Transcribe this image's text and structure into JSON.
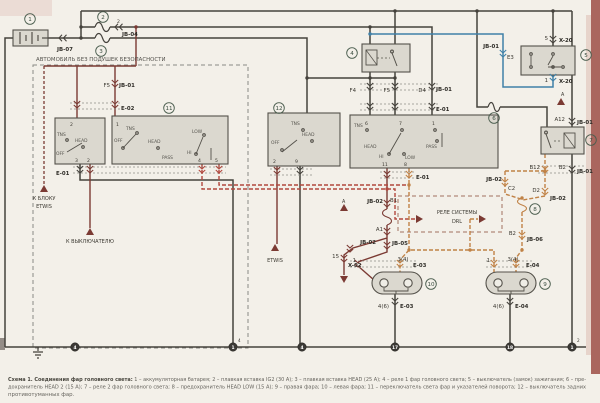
{
  "region_note": "АВТОМОБИЛЬ БЕЗ ПОДУШЕК БЕЗОПАСНОСТИ",
  "caption": {
    "bold": "Схема 1. Соединения фар головного света:",
    "line1": " 1 – аккумуляторная батарея; 2 – плавкая вставка IG2 (30 А); 3 – плавкая вставка HEAD (25 А); 4 – реле 1 фар головного света; 5 – выключатель (замок) зажигания; 6 – пре-",
    "line2": "дохранитель HEAD 2 (15 А); 7 – реле 2 фар головного света; 8 – предохранитель HEAD LOW (15 А); 9 – правая фара; 10 – левая фара; 11 – переключатель света фар и указателей поворота; 12 – выключатель задних",
    "line3": "противотуманных фар."
  },
  "labels": [
    {
      "t": "JB-07",
      "x": 57,
      "y": 51,
      "b": 1
    },
    {
      "t": "JB-04",
      "x": 122,
      "y": 36,
      "b": 1
    },
    {
      "t": "2",
      "x": 117,
      "y": 23,
      "s": 4.6
    },
    {
      "t": "АВТОМОБИЛЬ БЕЗ ПОДУШЕК БЕЗОПАСНОСТИ",
      "x": 36,
      "y": 61,
      "s": 5.4,
      "c": "#55534e"
    },
    {
      "t": "F5",
      "x": 110,
      "y": 87,
      "a": "e"
    },
    {
      "t": "JB-01",
      "x": 119,
      "y": 87,
      "b": 1
    },
    {
      "t": "E-02",
      "x": 121,
      "y": 110,
      "b": 1
    },
    {
      "t": "E-01",
      "x": 56,
      "y": 175,
      "b": 1
    },
    {
      "t": "К БЛОКУ",
      "x": 44,
      "y": 200,
      "a": "m",
      "s": 5
    },
    {
      "t": "ETWIS",
      "x": 44,
      "y": 208,
      "a": "m",
      "s": 5
    },
    {
      "t": "К ВЫКЛЮЧАТЕЛЮ",
      "x": 90,
      "y": 243,
      "a": "m",
      "s": 5
    },
    {
      "t": "ETWIS",
      "x": 275,
      "y": 262,
      "a": "m",
      "s": 5
    },
    {
      "t": "2",
      "x": 70,
      "y": 126,
      "s": 4.6
    },
    {
      "t": "TNS",
      "x": 57,
      "y": 136,
      "s": 4.4,
      "c": "#55534d"
    },
    {
      "t": "HEAD",
      "x": 75,
      "y": 142,
      "s": 4.4,
      "c": "#55534d"
    },
    {
      "t": "OFF",
      "x": 56,
      "y": 155,
      "s": 4.4,
      "c": "#55534d"
    },
    {
      "t": "3",
      "x": 75,
      "y": 162,
      "s": 4.6
    },
    {
      "t": "2",
      "x": 87,
      "y": 162,
      "s": 4.6
    },
    {
      "t": "1",
      "x": 116,
      "y": 126,
      "s": 4.6
    },
    {
      "t": "TNS",
      "x": 126,
      "y": 130,
      "s": 4.4,
      "c": "#55534d"
    },
    {
      "t": "OFF",
      "x": 114,
      "y": 142,
      "s": 4.4,
      "c": "#55534d"
    },
    {
      "t": "HEAD",
      "x": 148,
      "y": 143,
      "s": 4.4,
      "c": "#55534d"
    },
    {
      "t": "LOW",
      "x": 192,
      "y": 133,
      "s": 4.4,
      "c": "#55534d"
    },
    {
      "t": "HI",
      "x": 187,
      "y": 154,
      "s": 4.4,
      "c": "#55534d"
    },
    {
      "t": "PASS",
      "x": 162,
      "y": 159,
      "s": 4.4,
      "c": "#55534d"
    },
    {
      "t": "4",
      "x": 198,
      "y": 162,
      "s": 4.6
    },
    {
      "t": "5",
      "x": 215,
      "y": 162,
      "s": 4.6
    },
    {
      "t": "F4",
      "x": 356,
      "y": 92,
      "a": "e"
    },
    {
      "t": "F5",
      "x": 390,
      "y": 92,
      "a": "e"
    },
    {
      "t": "D4",
      "x": 426,
      "y": 92,
      "a": "e"
    },
    {
      "t": "JB-01",
      "x": 436,
      "y": 91,
      "b": 1
    },
    {
      "t": "E-01",
      "x": 436,
      "y": 111,
      "b": 1
    },
    {
      "t": "6",
      "x": 365,
      "y": 125,
      "s": 4.6
    },
    {
      "t": "7",
      "x": 399,
      "y": 125,
      "s": 4.6
    },
    {
      "t": "1",
      "x": 432,
      "y": 125,
      "s": 4.6
    },
    {
      "t": "TNS",
      "x": 354,
      "y": 127,
      "s": 4.4,
      "c": "#55534d"
    },
    {
      "t": "HEAD",
      "x": 364,
      "y": 148,
      "s": 4.4,
      "c": "#55534d"
    },
    {
      "t": "HI",
      "x": 379,
      "y": 158,
      "s": 4.4,
      "c": "#55534d"
    },
    {
      "t": "LOW",
      "x": 405,
      "y": 159,
      "s": 4.4,
      "c": "#55534d"
    },
    {
      "t": "PASS",
      "x": 426,
      "y": 148,
      "s": 4.4,
      "c": "#55534d"
    },
    {
      "t": "11",
      "x": 382,
      "y": 166,
      "s": 4.6
    },
    {
      "t": "8",
      "x": 404,
      "y": 166,
      "s": 4.6
    },
    {
      "t": "E-01",
      "x": 416,
      "y": 179,
      "b": 1
    },
    {
      "t": "TNS",
      "x": 291,
      "y": 125,
      "s": 4.4,
      "c": "#55534d"
    },
    {
      "t": "HEAD",
      "x": 302,
      "y": 136,
      "s": 4.4,
      "c": "#55534d"
    },
    {
      "t": "OFF",
      "x": 271,
      "y": 144,
      "s": 4.4,
      "c": "#55534d"
    },
    {
      "t": "2",
      "x": 273,
      "y": 163,
      "s": 4.6
    },
    {
      "t": "9",
      "x": 295,
      "y": 163,
      "s": 4.6
    },
    {
      "t": "JB-02",
      "x": 383,
      "y": 203,
      "a": "e",
      "b": 1
    },
    {
      "t": "B1",
      "x": 390,
      "y": 202
    },
    {
      "t": "A1",
      "x": 383,
      "y": 231,
      "a": "e"
    },
    {
      "t": "JB-02",
      "x": 376,
      "y": 244,
      "a": "e",
      "b": 1
    },
    {
      "t": "JB-05",
      "x": 392,
      "y": 245,
      "b": 1
    },
    {
      "t": "15",
      "x": 339,
      "y": 258,
      "a": "e"
    },
    {
      "t": "X-02",
      "x": 348,
      "y": 267,
      "b": 1
    },
    {
      "t": "РЕЛЕ СИСТЕМЫ",
      "x": 457,
      "y": 214,
      "a": "m",
      "s": 5
    },
    {
      "t": "DRL",
      "x": 457,
      "y": 223,
      "a": "m",
      "s": 5
    },
    {
      "t": "JB-02",
      "x": 502,
      "y": 181,
      "a": "e",
      "b": 1
    },
    {
      "t": "C2",
      "x": 508,
      "y": 190
    },
    {
      "t": "B12",
      "x": 540,
      "y": 169,
      "a": "e"
    },
    {
      "t": "D2",
      "x": 540,
      "y": 192,
      "a": "e"
    },
    {
      "t": "JB-02",
      "x": 550,
      "y": 200,
      "b": 1
    },
    {
      "t": "B2",
      "x": 516,
      "y": 235,
      "a": "e"
    },
    {
      "t": "JB-06",
      "x": 527,
      "y": 241,
      "b": 1
    },
    {
      "t": "A12",
      "x": 565,
      "y": 121,
      "a": "e"
    },
    {
      "t": "JB-01",
      "x": 577,
      "y": 124,
      "b": 1
    },
    {
      "t": "B2",
      "x": 566,
      "y": 169,
      "a": "e"
    },
    {
      "t": "JB-01",
      "x": 577,
      "y": 173,
      "b": 1
    },
    {
      "t": "5",
      "x": 548,
      "y": 40,
      "a": "e"
    },
    {
      "t": "X-20",
      "x": 559,
      "y": 42,
      "b": 1
    },
    {
      "t": "1",
      "x": 548,
      "y": 82,
      "a": "e"
    },
    {
      "t": "X-20",
      "x": 559,
      "y": 83,
      "b": 1
    },
    {
      "t": "JB-01",
      "x": 499,
      "y": 48,
      "a": "e",
      "b": 1
    },
    {
      "t": "E3",
      "x": 507,
      "y": 59
    },
    {
      "t": "1",
      "x": 356,
      "y": 262,
      "a": "e"
    },
    {
      "t": "3(4)",
      "x": 403,
      "y": 261,
      "a": "m"
    },
    {
      "t": "E-03",
      "x": 413,
      "y": 267,
      "b": 1
    },
    {
      "t": "4(6)",
      "x": 389,
      "y": 308,
      "a": "e"
    },
    {
      "t": "E-03",
      "x": 400,
      "y": 308,
      "b": 1
    },
    {
      "t": "1",
      "x": 490,
      "y": 262,
      "a": "e"
    },
    {
      "t": "3(4)",
      "x": 513,
      "y": 261,
      "a": "m"
    },
    {
      "t": "E-04",
      "x": 526,
      "y": 267,
      "b": 1
    },
    {
      "t": "4(6)",
      "x": 504,
      "y": 308,
      "a": "e"
    },
    {
      "t": "E-04",
      "x": 515,
      "y": 308,
      "b": 1
    },
    {
      "t": "A",
      "x": 342,
      "y": 203,
      "s": 4.8
    },
    {
      "t": "A",
      "x": 561,
      "y": 96,
      "s": 4.8
    },
    {
      "t": "4",
      "x": 238,
      "y": 342,
      "s": 4.2
    },
    {
      "t": "2",
      "x": 577,
      "y": 342,
      "s": 4.2
    }
  ],
  "component_numbers": [
    {
      "n": "1",
      "x": 30,
      "y": 19
    },
    {
      "n": "2",
      "x": 103,
      "y": 17
    },
    {
      "n": "3",
      "x": 101,
      "y": 51
    },
    {
      "n": "4",
      "x": 352,
      "y": 53
    },
    {
      "n": "5",
      "x": 586,
      "y": 55
    },
    {
      "n": "6",
      "x": 494,
      "y": 118
    },
    {
      "n": "7",
      "x": 591,
      "y": 140
    },
    {
      "n": "8",
      "x": 535,
      "y": 209
    },
    {
      "n": "9",
      "x": 545,
      "y": 284
    },
    {
      "n": "10",
      "x": 431,
      "y": 284
    },
    {
      "n": "11",
      "x": 169,
      "y": 108
    },
    {
      "n": "12",
      "x": 279,
      "y": 108
    }
  ],
  "ground_nodes": [
    {
      "n": "4",
      "x": 75,
      "y": 347
    },
    {
      "n": "1",
      "x": 233,
      "y": 347
    },
    {
      "n": "4",
      "x": 302,
      "y": 347
    },
    {
      "n": "17",
      "x": 395,
      "y": 347
    },
    {
      "n": "18",
      "x": 510,
      "y": 347
    },
    {
      "n": "1",
      "x": 572,
      "y": 347
    }
  ]
}
